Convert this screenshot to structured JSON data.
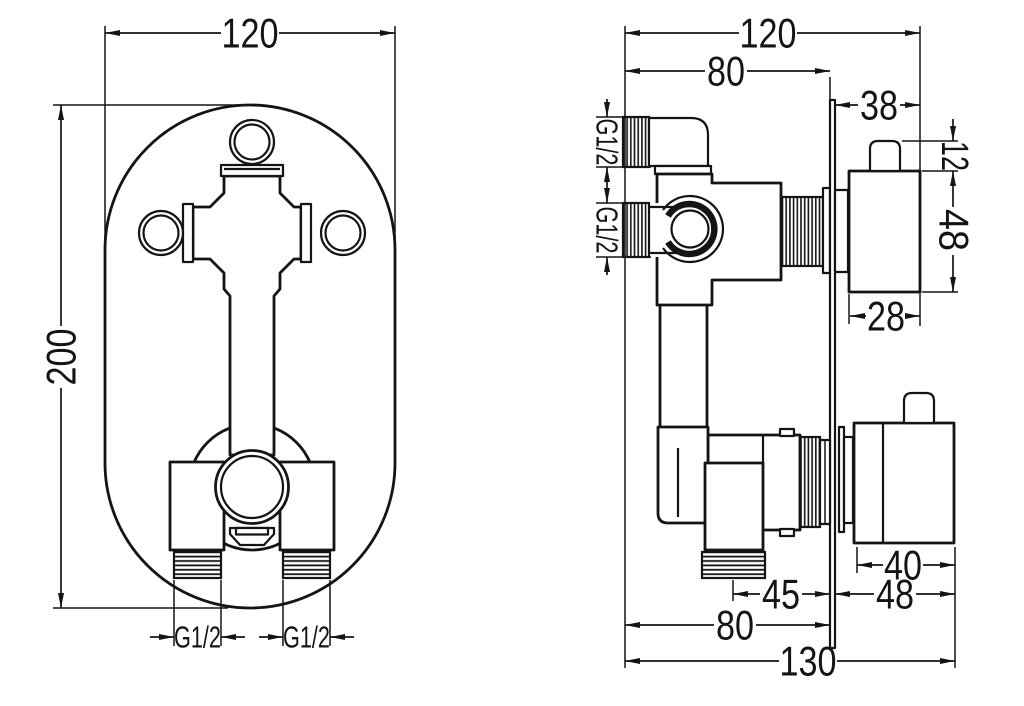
{
  "colors": {
    "line": "#141414",
    "background": "#ffffff"
  },
  "left_view": {
    "width": "120",
    "height": "200",
    "left_outlet_thread": "G1/2",
    "right_outlet_thread": "G1/2"
  },
  "right_view": {
    "total_width": "120",
    "body_width": "80",
    "trim_depth_top": "38",
    "top_inlet_thread": "G1/2",
    "bottom_inlet_thread": "G1/2",
    "knob_height": "12",
    "handle_height": "48",
    "handle_width_top": "28",
    "handle_width_bottom": "40",
    "trim_depth_bottom": "48",
    "outlet_offset": "45",
    "body_depth": "80",
    "total_depth": "130"
  }
}
